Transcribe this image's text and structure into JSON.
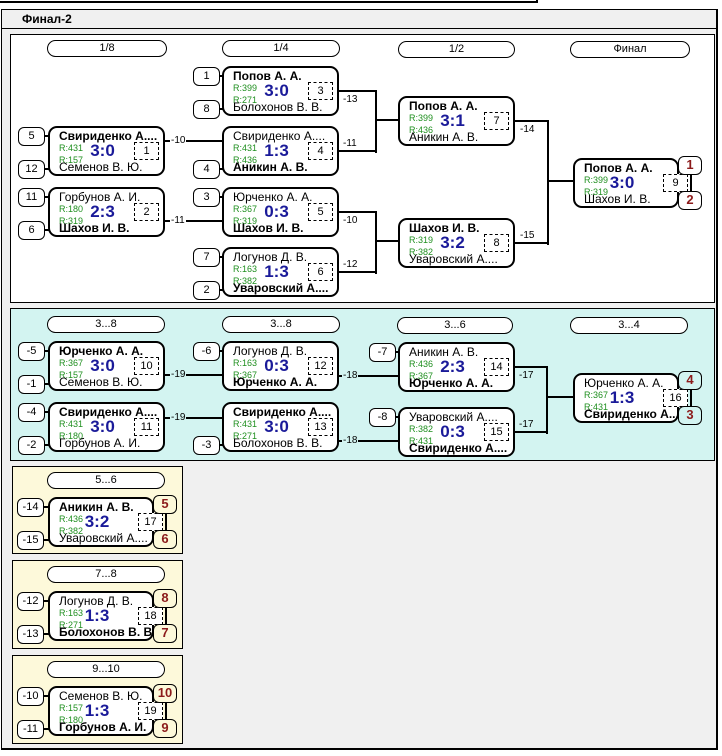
{
  "title": "Финал-2",
  "headers": {
    "main": [
      "1/8",
      "1/4",
      "1/2",
      "Финал"
    ],
    "consolation": [
      "3...8",
      "3...8",
      "3...6",
      "3...4"
    ],
    "place_5_6": "5...6",
    "place_7_8": "7...8",
    "place_9_10": "9...10"
  },
  "matches": [
    {
      "id": "m1",
      "round": "1/8",
      "match_no": "1",
      "seed_top": "5",
      "seed_bottom": "12",
      "player_top": "Свириденко А....",
      "rating_top": "R:431",
      "player_bottom": "Семенов В. Ю.",
      "rating_bottom": "R:157",
      "score": "3:0",
      "winner": "top"
    },
    {
      "id": "m2",
      "round": "1/8",
      "match_no": "2",
      "seed_top": "11",
      "seed_bottom": "6",
      "player_top": "Горбунов А. И.",
      "rating_top": "R:180",
      "player_bottom": "Шахов И. В.",
      "rating_bottom": "R:319",
      "score": "2:3",
      "winner": "bottom"
    },
    {
      "id": "m3",
      "round": "1/4",
      "match_no": "3",
      "seed_top": "1",
      "seed_bottom": "8",
      "player_top": "Попов А. А.",
      "rating_top": "R:399",
      "player_bottom": "Болохонов В. В.",
      "rating_bottom": "R:271",
      "score": "3:0",
      "winner": "top"
    },
    {
      "id": "m4",
      "round": "1/4",
      "match_no": "4",
      "seed_bottom": "4",
      "player_top": "Свириденко А....",
      "rating_top": "R:431",
      "player_bottom": "Аникин А. В.",
      "rating_bottom": "R:436",
      "score": "1:3",
      "winner": "bottom"
    },
    {
      "id": "m5",
      "round": "1/4",
      "match_no": "5",
      "seed_top": "3",
      "player_top": "Юрченко А. А.",
      "rating_top": "R:367",
      "player_bottom": "Шахов И. В.",
      "rating_bottom": "R:319",
      "score": "0:3",
      "winner": "bottom"
    },
    {
      "id": "m6",
      "round": "1/4",
      "match_no": "6",
      "seed_top": "7",
      "seed_bottom": "2",
      "player_top": "Логунов Д. В.",
      "rating_top": "R:163",
      "player_bottom": "Уваровский А....",
      "rating_bottom": "R:382",
      "score": "1:3",
      "winner": "bottom"
    },
    {
      "id": "m7",
      "round": "1/2",
      "match_no": "7",
      "player_top": "Попов А. А.",
      "rating_top": "R:399",
      "player_bottom": "Аникин А. В.",
      "rating_bottom": "R:436",
      "score": "3:1",
      "winner": "top"
    },
    {
      "id": "m8",
      "round": "1/2",
      "match_no": "8",
      "player_top": "Шахов И. В.",
      "rating_top": "R:319",
      "player_bottom": "Уваровский А....",
      "rating_bottom": "R:382",
      "score": "3:2",
      "winner": "top"
    },
    {
      "id": "m9",
      "round": "Финал",
      "match_no": "9",
      "player_top": "Попов А. А.",
      "rating_top": "R:399",
      "player_bottom": "Шахов И. В.",
      "rating_bottom": "R:319",
      "score": "3:0",
      "winner": "top",
      "place_top": "1",
      "place_bottom": "2"
    },
    {
      "id": "m10",
      "round": "3...8",
      "match_no": "10",
      "seed_top": "-5",
      "seed_bottom": "-1",
      "player_top": "Юрченко А. А.",
      "rating_top": "R:367",
      "player_bottom": "Семенов В. Ю.",
      "rating_bottom": "R:157",
      "score": "3:0",
      "winner": "top"
    },
    {
      "id": "m11",
      "round": "3...8",
      "match_no": "11",
      "seed_top": "-4",
      "seed_bottom": "-2",
      "player_top": "Свириденко А....",
      "rating_top": "R:431",
      "player_bottom": "Горбунов А. И.",
      "rating_bottom": "R:180",
      "score": "3:0",
      "winner": "top"
    },
    {
      "id": "m12",
      "round": "3...8",
      "match_no": "12",
      "seed_top": "-6",
      "player_top": "Логунов Д. В.",
      "rating_top": "R:163",
      "player_bottom": "Юрченко А. А.",
      "rating_bottom": "R:367",
      "score": "0:3",
      "winner": "bottom"
    },
    {
      "id": "m13",
      "round": "3...8",
      "match_no": "13",
      "seed_bottom": "-3",
      "player_top": "Свириденко А....",
      "rating_top": "R:431",
      "player_bottom": "Болохонов В. В.",
      "rating_bottom": "R:271",
      "score": "3:0",
      "winner": "top"
    },
    {
      "id": "m14",
      "round": "3...6",
      "match_no": "14",
      "seed_top": "-7",
      "player_top": "Аникин А. В.",
      "rating_top": "R:436",
      "player_bottom": "Юрченко А. А.",
      "rating_bottom": "R:367",
      "score": "2:3",
      "winner": "bottom"
    },
    {
      "id": "m15",
      "round": "3...6",
      "match_no": "15",
      "seed_top": "-8",
      "player_top": "Уваровский А....",
      "rating_top": "R:382",
      "player_bottom": "Свириденко А....",
      "rating_bottom": "R:431",
      "score": "0:3",
      "winner": "bottom"
    },
    {
      "id": "m16",
      "round": "3...4",
      "match_no": "16",
      "player_top": "Юрченко А. А.",
      "rating_top": "R:367",
      "player_bottom": "Свириденко А....",
      "rating_bottom": "R:431",
      "score": "1:3",
      "winner": "bottom",
      "place_top": "4",
      "place_bottom": "3"
    },
    {
      "id": "m17",
      "round": "5...6",
      "match_no": "17",
      "seed_top": "-14",
      "seed_bottom": "-15",
      "player_top": "Аникин А. В.",
      "rating_top": "R:436",
      "player_bottom": "Уваровский А....",
      "rating_bottom": "R:382",
      "score": "3:2",
      "winner": "top",
      "place_top": "5",
      "place_bottom": "6"
    },
    {
      "id": "m18",
      "round": "7...8",
      "match_no": "18",
      "seed_top": "-12",
      "seed_bottom": "-13",
      "player_top": "Логунов Д. В.",
      "rating_top": "R:163",
      "player_bottom": "Болохонов В. В.",
      "rating_bottom": "R:271",
      "score": "1:3",
      "winner": "bottom",
      "place_top": "8",
      "place_bottom": "7"
    },
    {
      "id": "m19",
      "round": "9...10",
      "match_no": "19",
      "seed_top": "-10",
      "seed_bottom": "-11",
      "player_top": "Семенов В. Ю.",
      "rating_top": "R:157",
      "player_bottom": "Горбунов А. И.",
      "rating_bottom": "R:180",
      "score": "1:3",
      "winner": "bottom",
      "place_top": "10",
      "place_bottom": "9"
    }
  ],
  "connector_labels": [
    "-10",
    "-11",
    "-13",
    "-11",
    "-10",
    "-12",
    "-14",
    "-15",
    "-19",
    "-19",
    "-18",
    "-18",
    "-17",
    "-17"
  ],
  "colors": {
    "score": "#1a1a99",
    "rating": "#1f8f1f",
    "place_number": "#8c1b1b",
    "consolation_panel_bg": "#d3f4f1",
    "place_panel_bg": "#fdf9da",
    "group_bg": "#f0f0f0"
  }
}
